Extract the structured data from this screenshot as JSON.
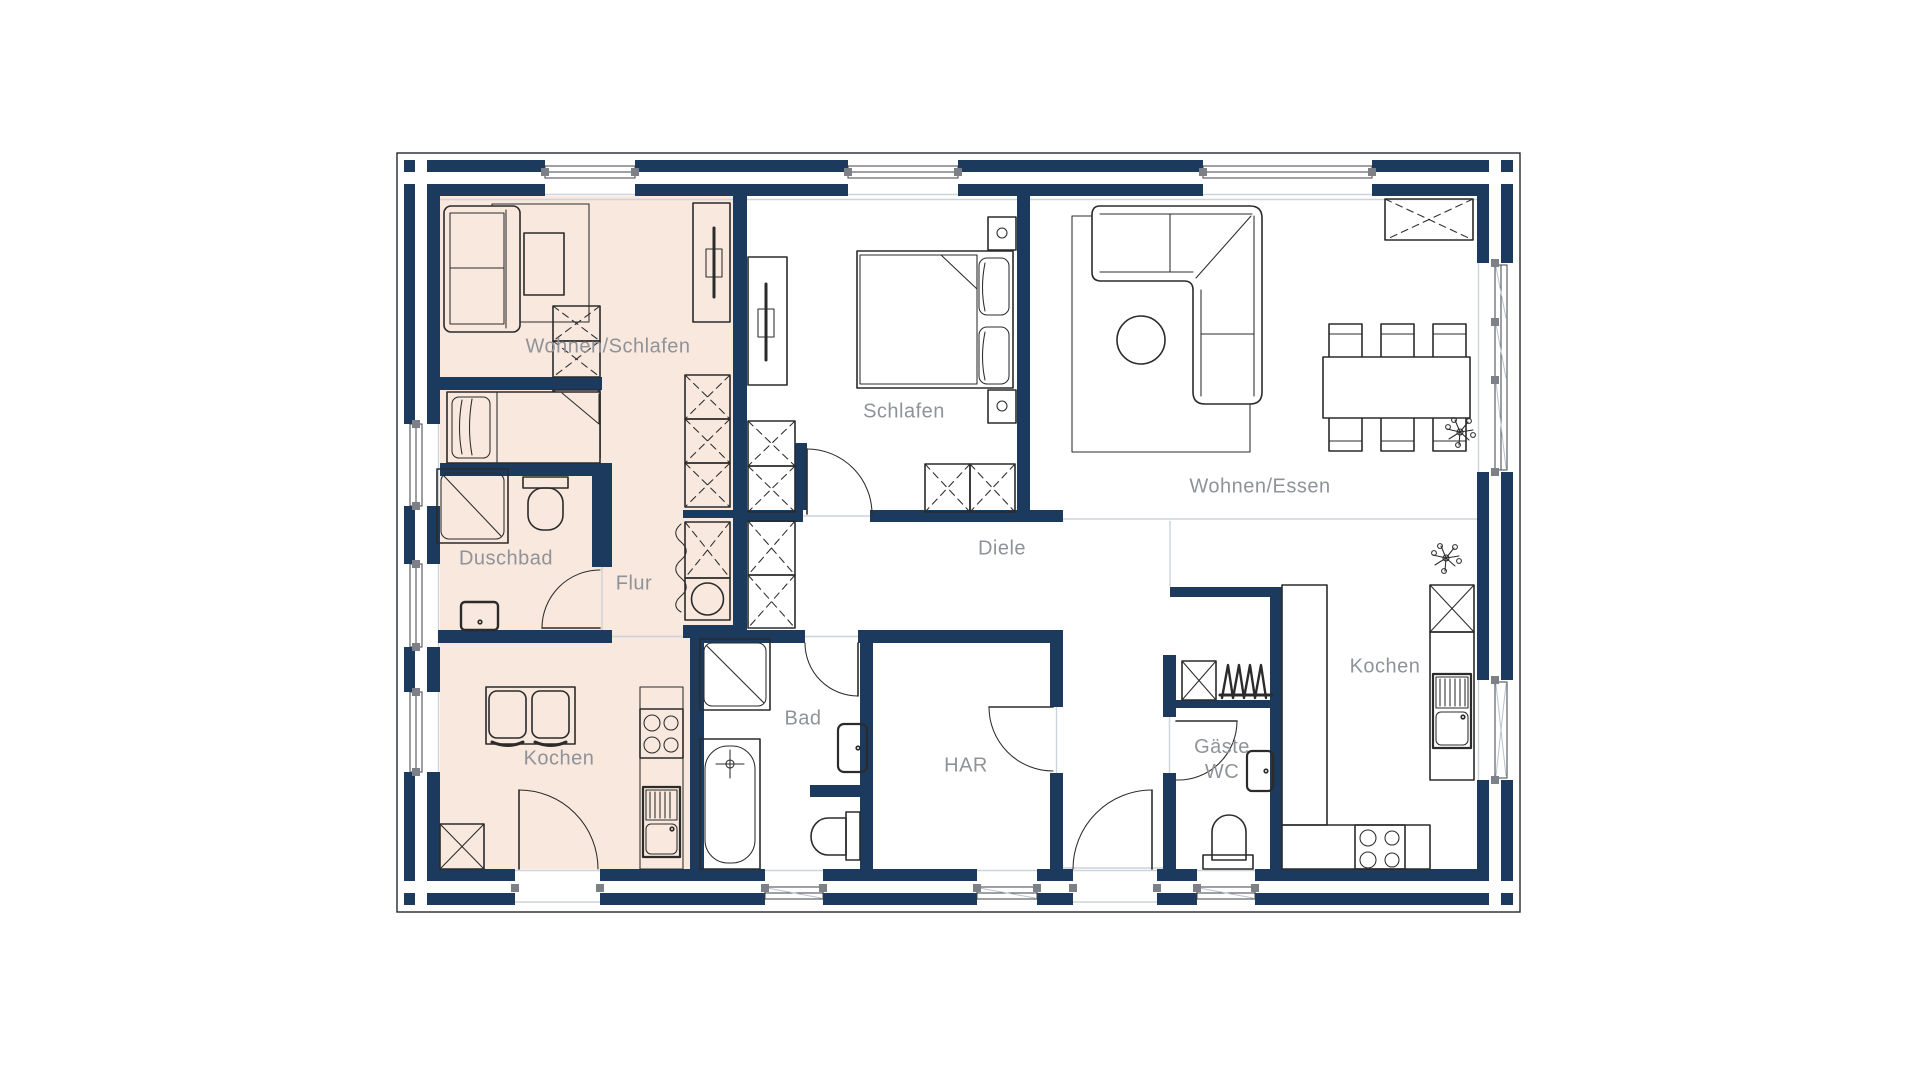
{
  "floorplan": {
    "type": "architectural-floor-plan",
    "rooms": [
      {
        "key": "wohnen_schlafen",
        "label": "Wohnen/Schlafen"
      },
      {
        "key": "schlafen",
        "label": "Schlafen"
      },
      {
        "key": "wohnen_essen",
        "label": "Wohnen/Essen"
      },
      {
        "key": "diele",
        "label": "Diele"
      },
      {
        "key": "duschbad",
        "label": "Duschbad"
      },
      {
        "key": "flur",
        "label": "Flur"
      },
      {
        "key": "kochen_flat",
        "label": "Kochen"
      },
      {
        "key": "bad",
        "label": "Bad"
      },
      {
        "key": "har",
        "label": "HAR"
      },
      {
        "key": "gaeste_wc",
        "label": "Gäste",
        "label2": "WC"
      },
      {
        "key": "kochen_main",
        "label": "Kochen"
      }
    ],
    "colors": {
      "wall": "#1b3a5e",
      "flat_area": "#f8e8dd",
      "label_text": "#8f9399",
      "furniture_line": "#2b2b2b",
      "jamb_marker": "#7d8187",
      "faint_line": "#ccd3da"
    }
  }
}
